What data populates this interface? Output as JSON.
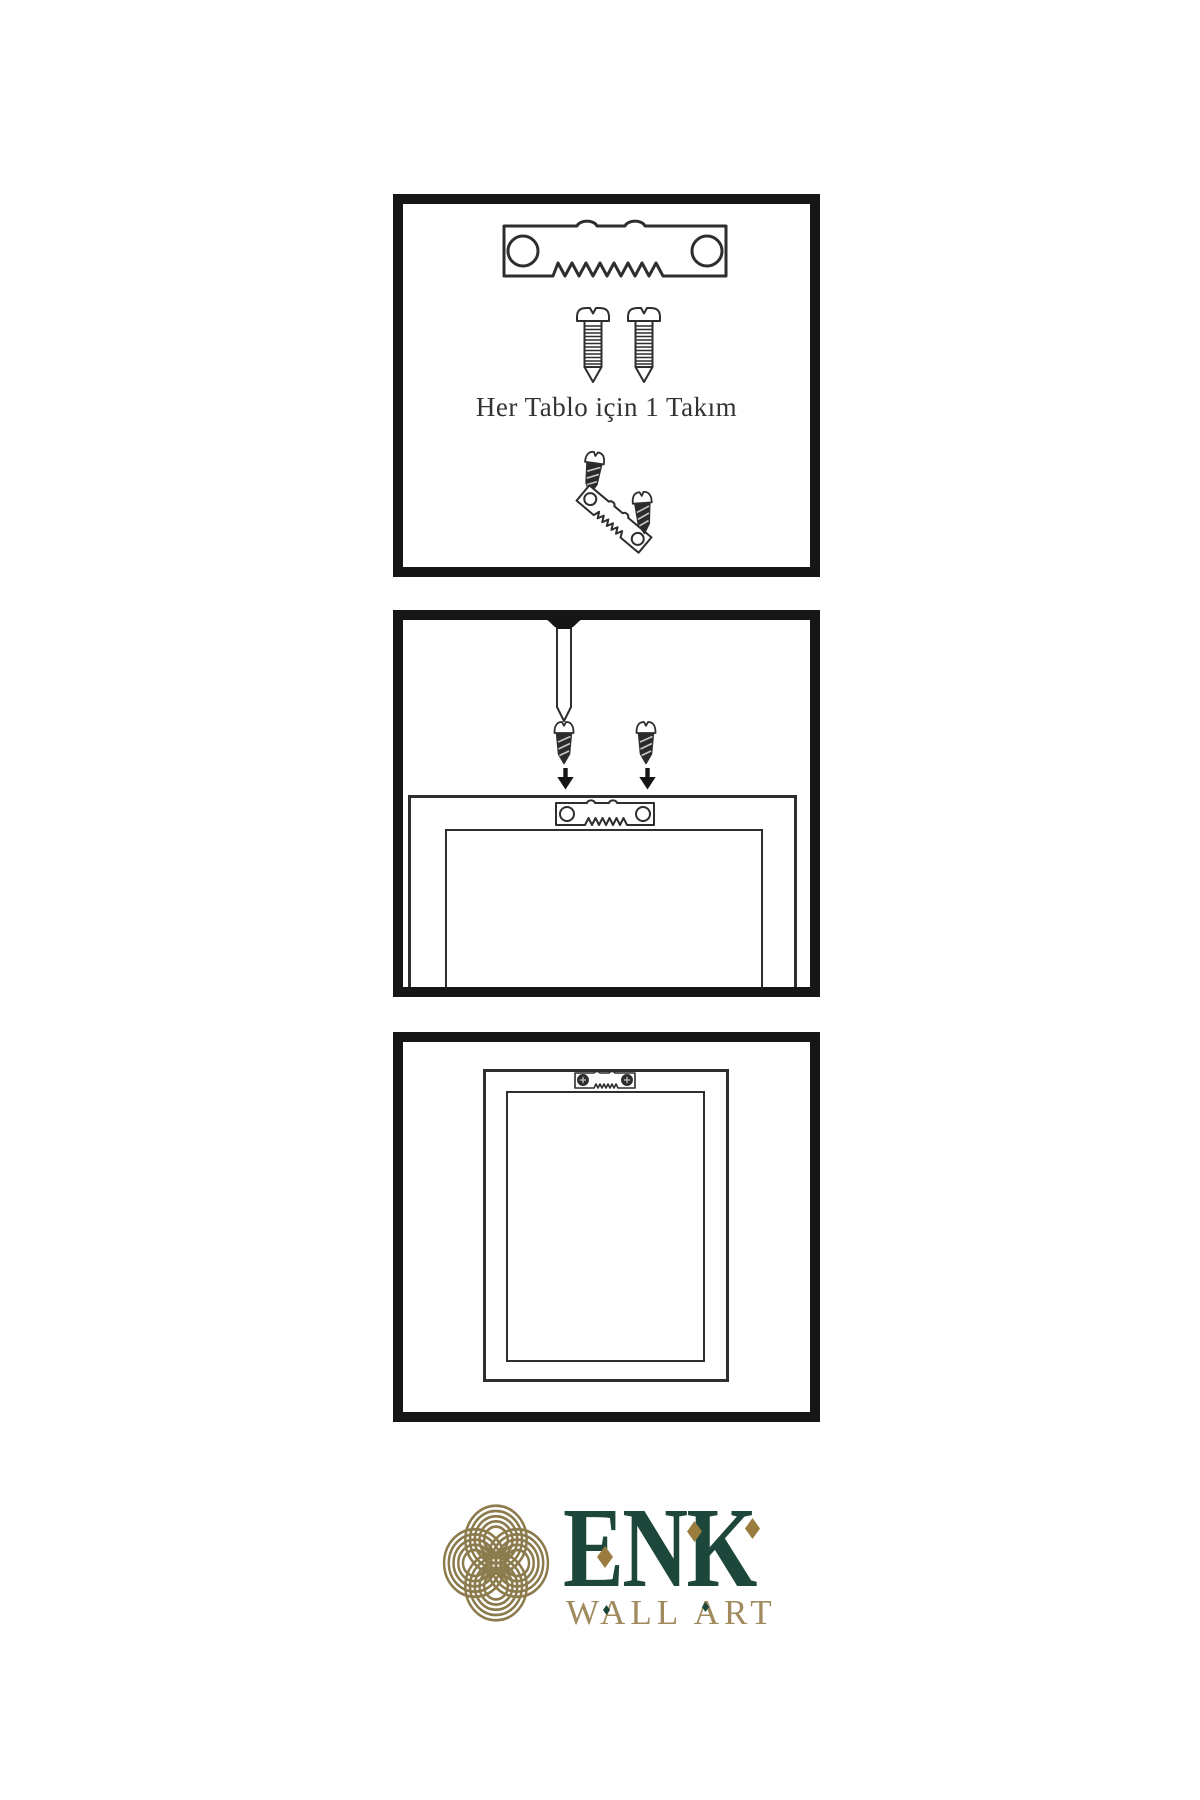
{
  "colors": {
    "ink": "#161616",
    "line": "#2e2e2e",
    "screw_dark": "#2b2b2b",
    "brand_green": "#1d473b",
    "brand_gold": "#8c7b4c",
    "brand_gold_dark": "#9a7c3e",
    "brand_gold_text": "#a08a5e"
  },
  "step1": {
    "caption": "Her Tablo için 1 Takım",
    "icon_names": [
      "sawtooth-hanger-icon",
      "screw-icon",
      "screw-icon",
      "tilted-screw-icon",
      "tilted-sawtooth-hanger-icon"
    ]
  },
  "step2": {
    "icon_names": [
      "wall-nail-icon",
      "dark-screw-icon",
      "dark-screw-icon",
      "arrow-down-icon",
      "arrow-down-icon",
      "sawtooth-hanger-icon",
      "picture-frame-outline"
    ]
  },
  "step3": {
    "icon_names": [
      "mounted-sawtooth-hanger-icon",
      "picture-frame-outline"
    ]
  },
  "logo": {
    "name": "ENK",
    "tagline": "WALL ART",
    "icon_name": "knot-logo-icon"
  }
}
